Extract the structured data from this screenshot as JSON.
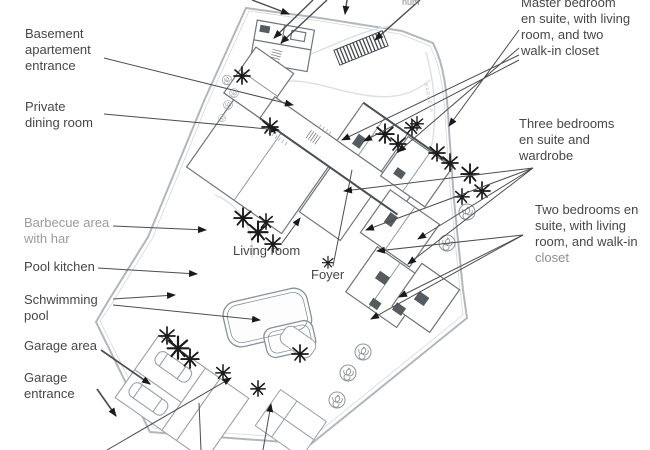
{
  "colors": {
    "label_text": "#474747",
    "muted_label": "#9b9b9b",
    "plan_line": "#9aa0a5",
    "wall_line": "#70757a",
    "arrow": "#1a1a1a",
    "background": "#ffffff"
  },
  "plan": {
    "labels": {
      "basement": "Basement\napartement\nentrance",
      "private_dining": "Private\ndining room",
      "barbecue": "Barbecue area\nwith har",
      "pool_kitchen": "Pool kitchen",
      "swimming_pool": "Schwimming\npool",
      "garage_area": "Garage area",
      "garage_entrance": "Garage\nentrance",
      "living_room": "Living room",
      "foyer": "Foyer",
      "master_bedroom": "Master bedroom\nen suite, with living\nroom, and two\nwalk-in closet",
      "three_bedrooms": "Three bedrooms\nen suite and\nwardrobe",
      "two_bedrooms": "Two bedrooms en\nsuite, with living\nroom, and walk-in",
      "two_bedrooms_closet": "closet",
      "parcela": "PARCELA",
      "top_cut_fragment": "num"
    }
  }
}
